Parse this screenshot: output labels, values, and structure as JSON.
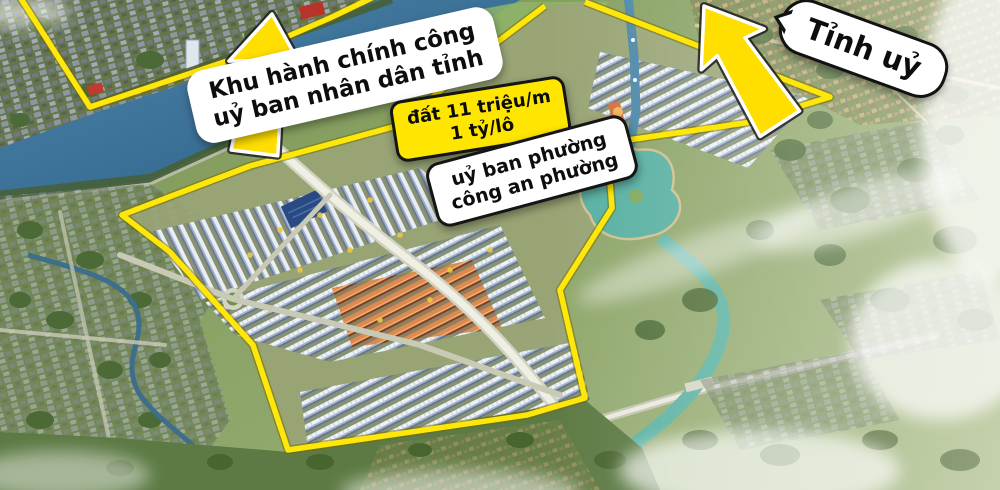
{
  "annotations": {
    "admin_area": {
      "line1": "Khu hành chính công",
      "line2": "uỷ ban nhân dân tỉnh"
    },
    "party_hq": {
      "label": "Tỉnh uỷ"
    },
    "price": {
      "line1": "đất 11 triệu/m",
      "line2": "1 tỷ/lô"
    },
    "ward": {
      "line1": "uỷ ban phường",
      "line2": "công an phường"
    }
  },
  "colors": {
    "boundary": "#ffe70a",
    "arrow_fill": "#ffdf00",
    "label_bg": "#ffffff",
    "price_bg": "#ffe600",
    "ink": "#0d0d0d",
    "river": "#3f7ca3",
    "canal": "#5cb3a3"
  }
}
